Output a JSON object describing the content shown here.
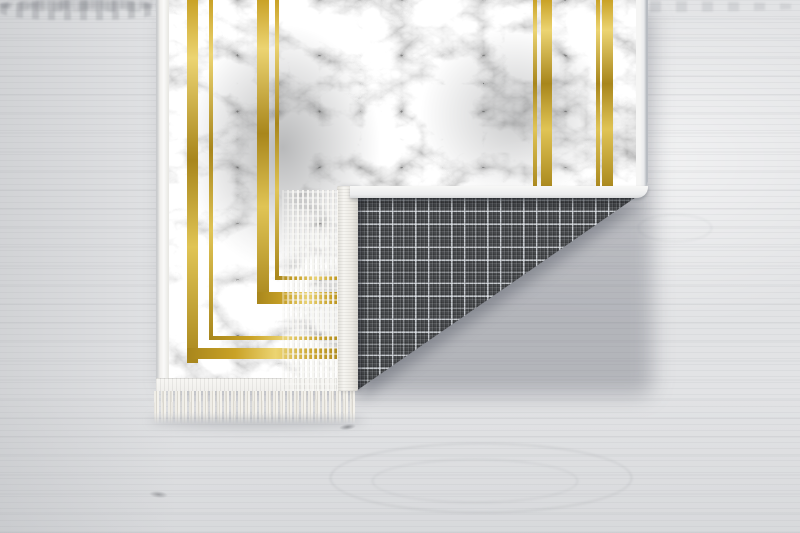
{
  "scene": {
    "type": "product-photograph",
    "subject": "rug-with-folded-corner",
    "description": "Gray marble-print rug with gold frame lines; near corner folded over revealing dark plaid woven backing with white binding and fringe; lying on whitewashed wood floor",
    "rug": {
      "face_pattern": "gray-marble",
      "accent_pattern": "gold-double-frame-lines",
      "edge": "white-binding",
      "fringe": "off-white-tassels",
      "back_pattern": "dark-gray-tartan-plaid"
    },
    "floor": {
      "material": "whitewashed-wood",
      "grain": "horizontal"
    }
  },
  "palette": {
    "floor-base": "#e2e3e5",
    "floor-grain": "#9fa2a7",
    "floor-light": "#eef0f1",
    "marble-base": "#b4b5b7",
    "marble-dark": "#7e8082",
    "marble-vein": "#f6f6f6",
    "gold-dark": "#a8861c",
    "gold-base": "#c9a227",
    "gold-light": "#ecd472",
    "binding": "#f0efec",
    "fringe": "#eceae3",
    "plaid-base": "#47494c",
    "plaid-line": "#d7dade",
    "shadow": "rgba(80,85,95,0.32)"
  }
}
